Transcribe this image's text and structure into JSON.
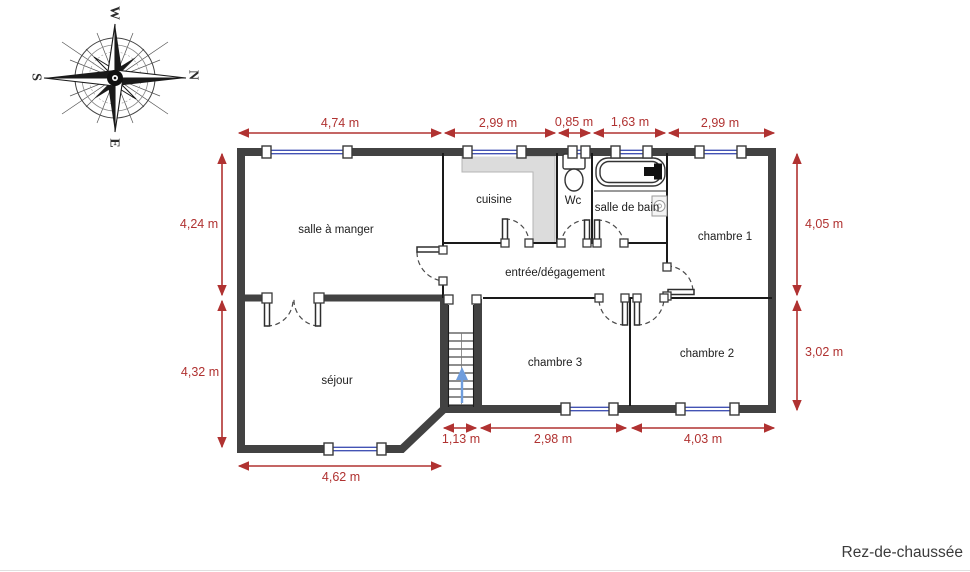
{
  "title": "Rez-de-chaussée",
  "compass": {
    "top": "W",
    "right": "N",
    "left": "S",
    "bottom": "E"
  },
  "rooms": {
    "salle_a_manger": "salle à manger",
    "cuisine": "cuisine",
    "wc": "Wc",
    "salle_de_bain": "salle de bain",
    "chambre1": "chambre 1",
    "entree": "entrée/dégagement",
    "sejour": "séjour",
    "chambre3": "chambre 3",
    "chambre2": "chambre 2"
  },
  "dimensions": {
    "top": [
      "4,74 m",
      "2,99 m",
      "0,85 m",
      "1,63 m",
      "2,99 m"
    ],
    "left": [
      "4,24 m",
      "4,32 m"
    ],
    "right": [
      "4,05 m",
      "3,02 m"
    ],
    "bottom_inner": [
      "1,13 m",
      "2,98 m",
      "4,03 m"
    ],
    "bottom_outer": [
      "4,62 m"
    ]
  },
  "colors": {
    "dimension_red": "#b03231",
    "wall_gray": "#424242",
    "window_blue": "#4353b4",
    "stair_arrow_blue": "#6f9ddd",
    "counter_gray": "#dcdcdc"
  }
}
